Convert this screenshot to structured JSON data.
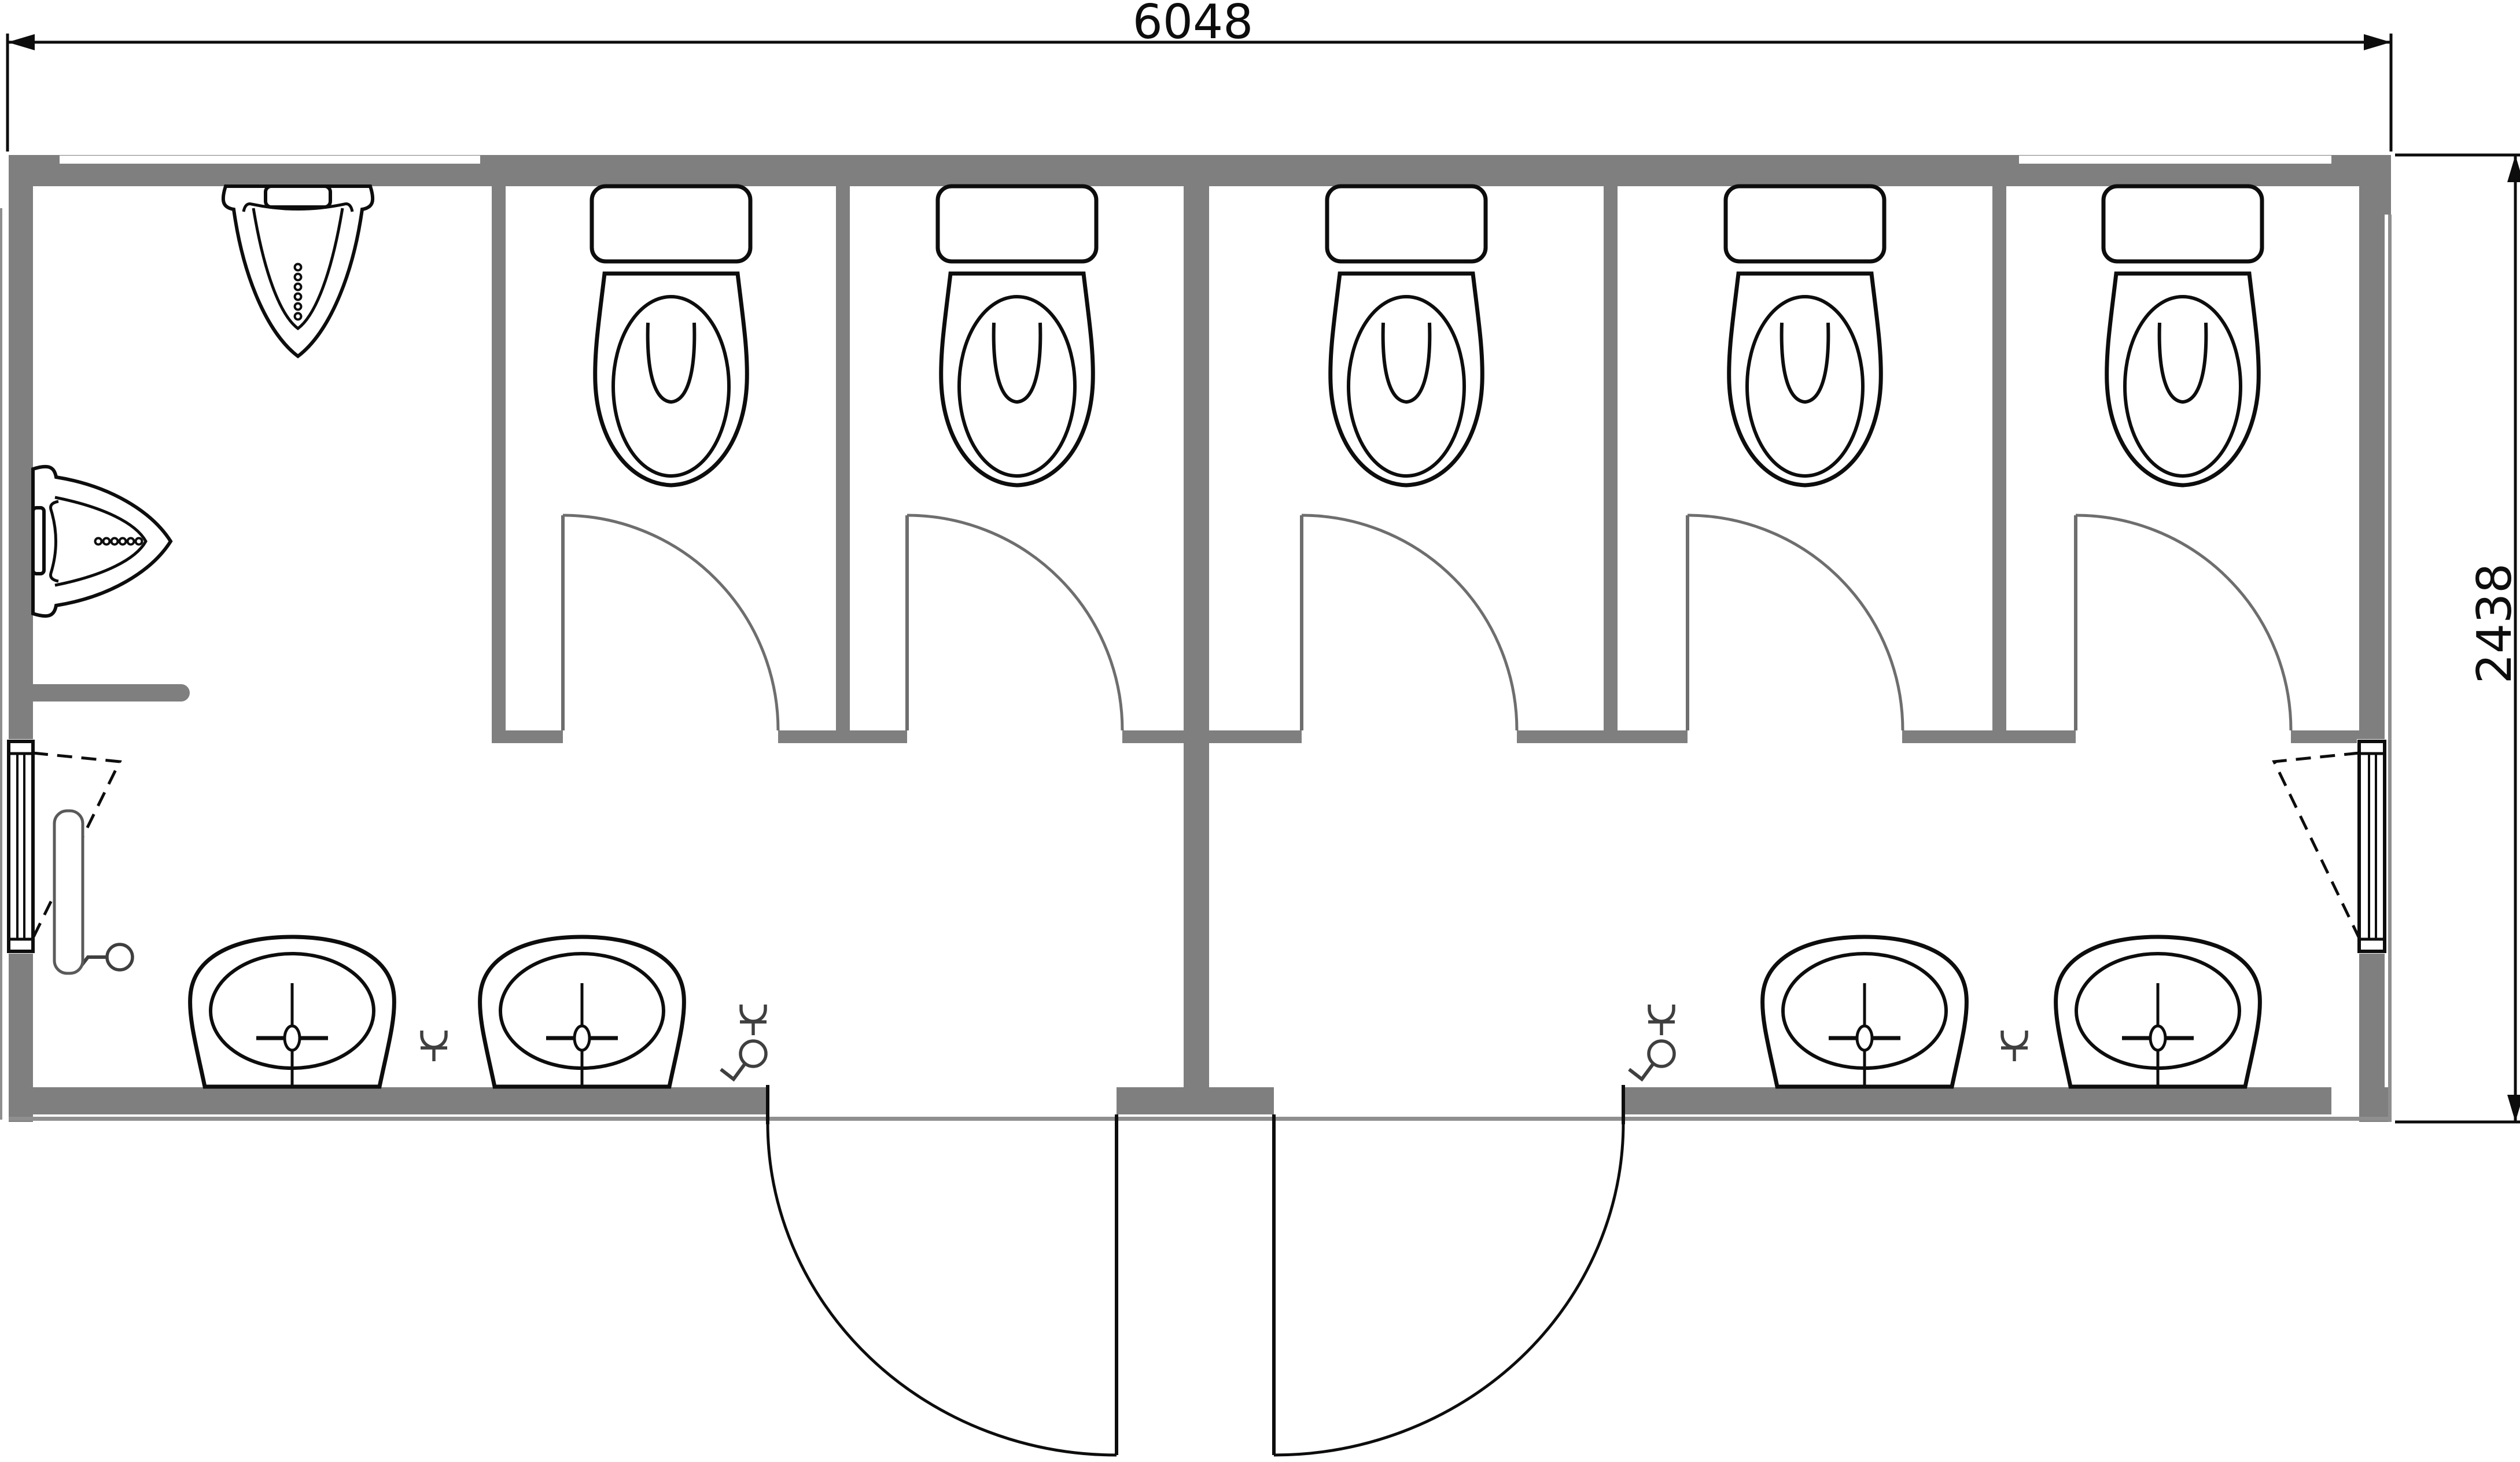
{
  "diagram": {
    "type": "floor-plan",
    "subject": "sanitary container with WC cubicles, urinals and wash basins"
  },
  "dimensions": {
    "width_label": "6048",
    "height_label": "2438"
  },
  "colors": {
    "background": "#ffffff",
    "wall": "#7f7f7f",
    "wall_light": "#8f8f8f",
    "line": "#0d0d0d",
    "stall_door": "#6e6e6e",
    "symbol": "#3f3f3f",
    "radiator": "#5a5a5a"
  },
  "fixtures": {
    "toilets": {
      "count": 5,
      "centers_x": [
        1160,
        1758,
        2431,
        3120,
        3773
      ]
    },
    "stall_doors": {
      "hinges_x": [
        973,
        1568,
        2250,
        2917,
        3588
      ],
      "opening": 372
    },
    "sinks": {
      "count": 4,
      "centers_x": [
        505,
        1006,
        3223,
        3730
      ]
    },
    "urinals": {
      "count": 2
    },
    "drain_symbols": {
      "positions": [
        [
          750,
          1790
        ],
        [
          3482,
          1790
        ],
        [
          1302,
          1745
        ],
        [
          2872,
          1745
        ]
      ]
    },
    "tap_symbols": {
      "positions": [
        [
          1302,
          1822
        ],
        [
          2872,
          1822
        ]
      ],
      "wall_position": [
        207,
        1655
      ]
    },
    "windows": {
      "count": 2
    },
    "radiator": {
      "count": 1
    },
    "entrance_doors": {
      "count": 2
    }
  }
}
